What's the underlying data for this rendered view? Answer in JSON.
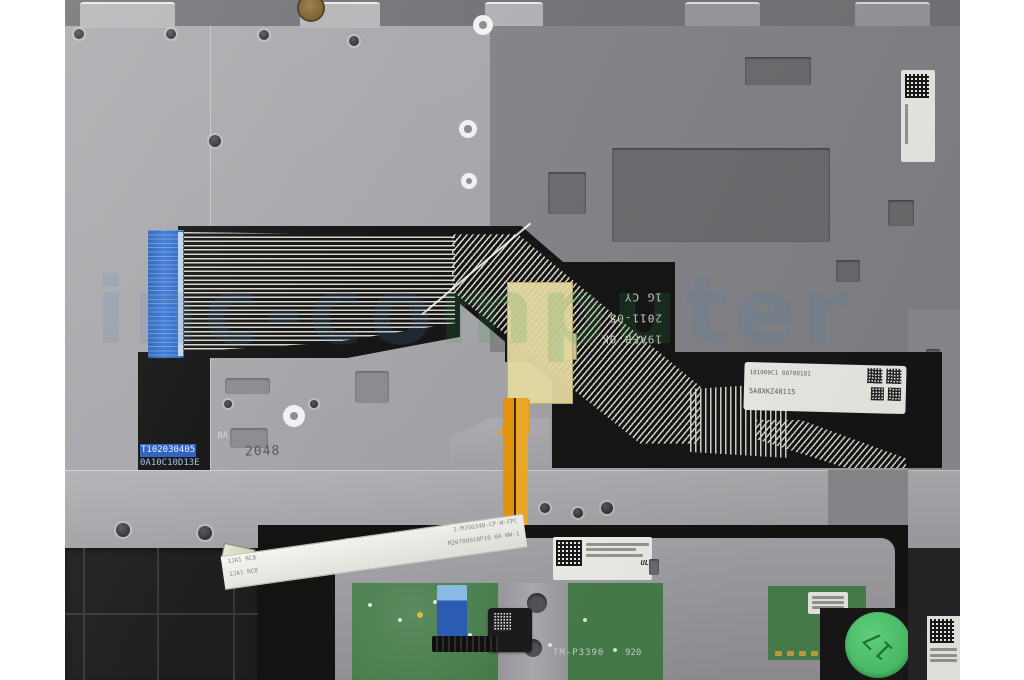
{
  "colors": {
    "page_bg": "#ffffff",
    "plate_light": "#a9a9ad",
    "plate_dark": "#85858a",
    "flex_black": "#161616",
    "trace": "#d9d7cc",
    "connector_blue": "#3b76d2",
    "kapton": "#eadfa6",
    "orange_cable": "#efa31d",
    "pcb_green": "#477f4b",
    "sticker_green": "#4fd06e"
  },
  "markings": {
    "flex_rotated_lines": [
      "19AFB-0K",
      "2011-05",
      "1G CY"
    ],
    "plate_stamp": "2048",
    "tail_label": [
      "8A",
      "T102030405",
      "0A10C10D13E"
    ],
    "flex_barcode_label": [
      "181000C1 00700181",
      "5A8XKZ40115"
    ],
    "orange_cable_vcc": "VCC",
    "orange_cable_gnd": "GND",
    "ribbon_row1_left": "1JA1  RC8",
    "ribbon_row1_right": "1-MJG6340-CP-W-FPC",
    "ribbon_row2_left": "1JA1  RC8",
    "ribbon_row2_right": "M20700010P10 04  WW-1",
    "touchpad_controller": "TM-P3390",
    "touchpad_controller_rev": "920",
    "ul_mark": "UL",
    "qc_sticker": "17"
  },
  "watermark": {
    "text_left": "inc-co",
    "text_mid": "mpu",
    "text_right": "ter"
  }
}
